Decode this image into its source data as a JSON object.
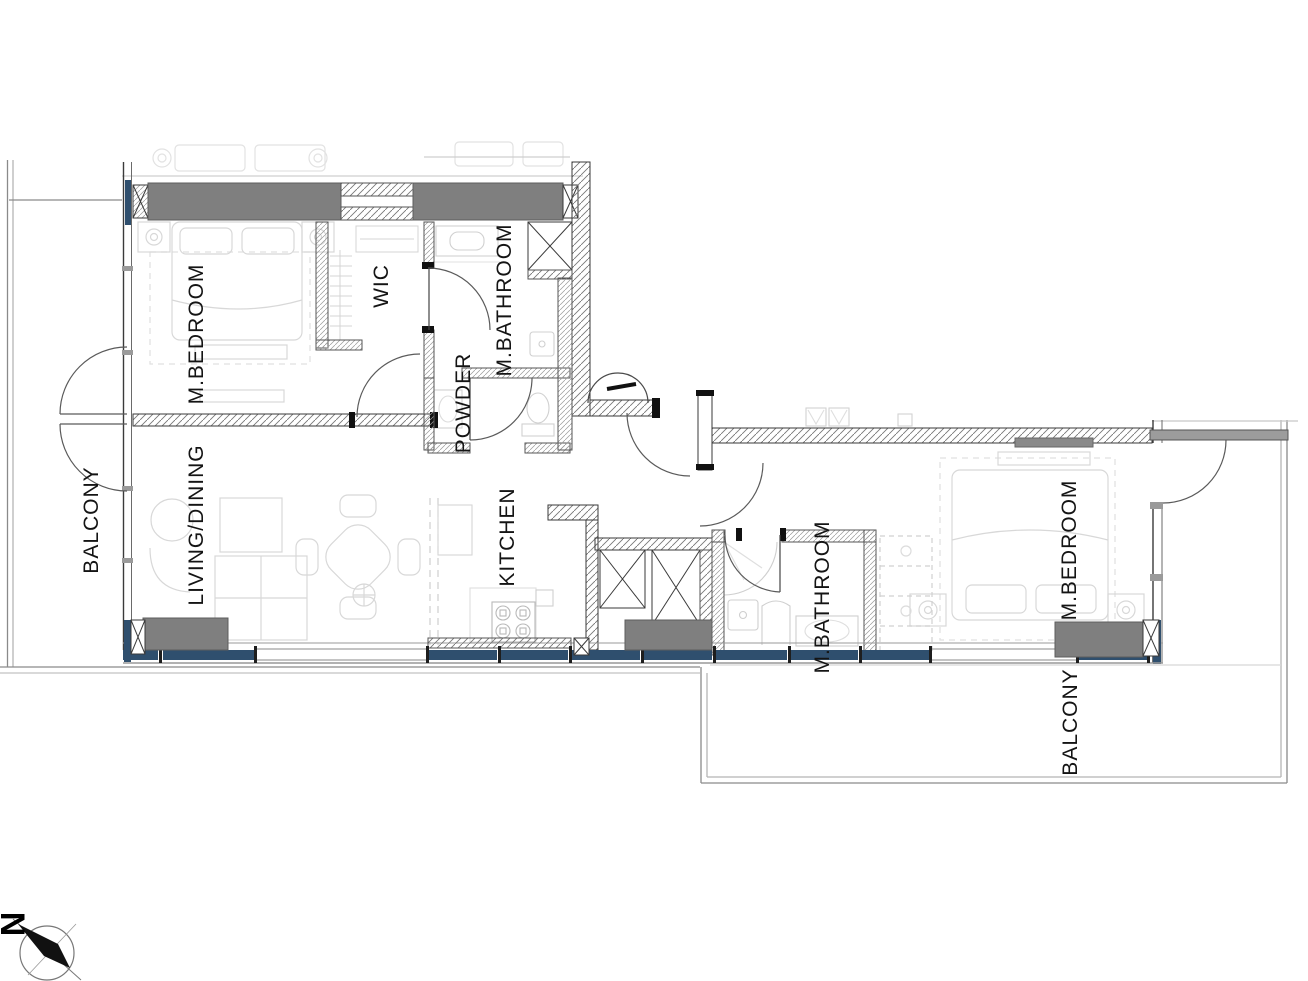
{
  "drawing": {
    "title": "apartment-floor-plan",
    "colors": {
      "wall_fill": "#7f7f7f",
      "window_frame": "#2f4f6e",
      "line": "#3a3a3a",
      "furniture_faint": "#d8d8d8"
    },
    "labels": {
      "m_bedroom_left": "M.BEDROOM",
      "wic": "WIC",
      "m_bathroom_top": "M.BATHROOM",
      "powder": "POWDER",
      "balcony_left": "BALCONY",
      "living_dining": "LIVING/DINING",
      "kitchen": "KITCHEN",
      "m_bathroom_right": "M.BATHROOM",
      "m_bedroom_right": "M.BEDROOM",
      "balcony_bottom": "BALCONY",
      "north": "N"
    }
  }
}
